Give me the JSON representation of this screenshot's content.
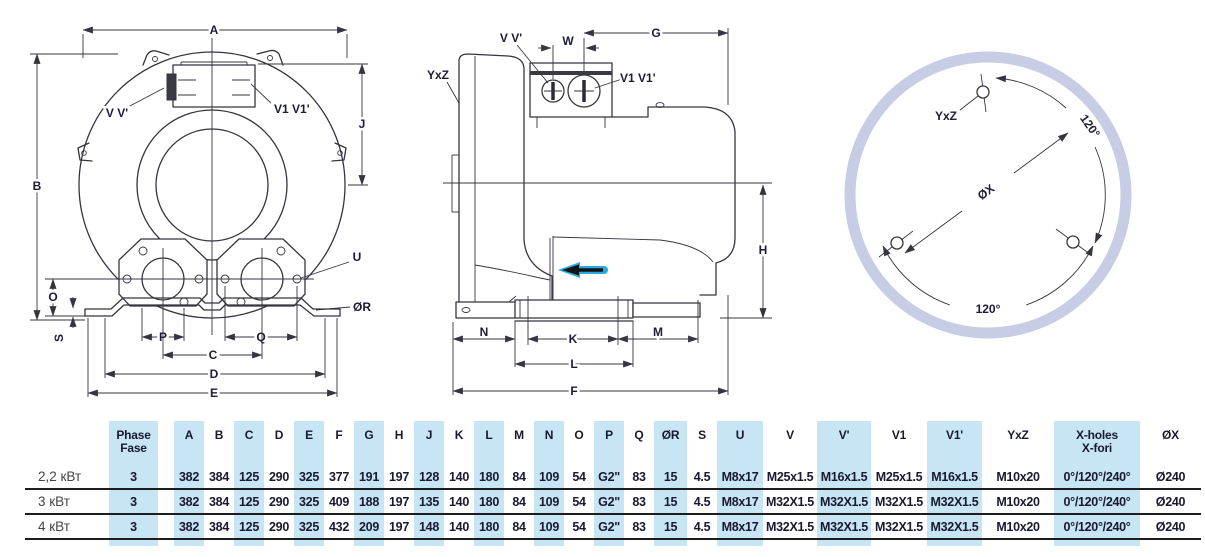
{
  "drawing": {
    "front_view": {
      "labels": {
        "A": "A",
        "B": "B",
        "J": "J",
        "vv": "V V'",
        "v1v1": "V1 V1'",
        "O": "O",
        "S": "S",
        "P": "P",
        "Q": "Q",
        "C": "C",
        "D": "D",
        "E": "E",
        "U": "U",
        "oR": "ØR"
      }
    },
    "side_view": {
      "labels": {
        "yxz": "YxZ",
        "vv": "V V'",
        "w": "W",
        "g": "G",
        "v1v1": "V1 V1'",
        "h": "H",
        "n": "N",
        "k": "K",
        "l": "L",
        "m": "M",
        "f": "F"
      }
    },
    "flange_view": {
      "labels": {
        "yxz": "YxZ",
        "ox": "ØX",
        "angle_top": "120°",
        "angle_bottom": "120°"
      }
    }
  },
  "table": {
    "headers": {
      "phase_line1": "Phase",
      "phase_line2": "Fase",
      "cols": [
        "A",
        "B",
        "C",
        "D",
        "E",
        "F",
        "G",
        "H",
        "J",
        "K",
        "L",
        "M",
        "N",
        "O",
        "P",
        "Q",
        "ØR",
        "S",
        "U",
        "V",
        "V'",
        "V1",
        "V1'",
        "YxZ"
      ],
      "xholes_line1": "X-holes",
      "xholes_line2": "X-fori",
      "ox": "ØX"
    },
    "rows": [
      {
        "label": "2,2 кВт",
        "phase": "3",
        "values": [
          "382",
          "384",
          "125",
          "290",
          "325",
          "377",
          "191",
          "197",
          "128",
          "140",
          "180",
          "84",
          "109",
          "54",
          "G2\"",
          "83",
          "15",
          "4.5",
          "M8x17",
          "M25x1.5",
          "M16x1.5",
          "M25x1.5",
          "M16x1.5",
          "M10x20",
          "0°/120°/240°",
          "Ø240"
        ]
      },
      {
        "label": "3 кВт",
        "phase": "3",
        "values": [
          "382",
          "384",
          "125",
          "290",
          "325",
          "409",
          "188",
          "197",
          "135",
          "140",
          "180",
          "84",
          "109",
          "54",
          "G2\"",
          "83",
          "15",
          "4.5",
          "M8x17",
          "M32X1.5",
          "M32X1.5",
          "M32X1.5",
          "M32X1.5",
          "M10x20",
          "0°/120°/240°",
          "Ø240"
        ]
      },
      {
        "label": "4 кВт",
        "phase": "3",
        "values": [
          "382",
          "384",
          "125",
          "290",
          "325",
          "432",
          "209",
          "197",
          "148",
          "140",
          "180",
          "84",
          "109",
          "54",
          "G2\"",
          "83",
          "15",
          "4.5",
          "M8x17",
          "M32X1.5",
          "M32X1.5",
          "M32X1.5",
          "M32X1.5",
          "M10x20",
          "0°/120°/240°",
          "Ø240"
        ]
      }
    ]
  },
  "colors": {
    "stripe": "#c7e5f5",
    "line": "#35353f",
    "text": "#191930",
    "flange_ring": "#c6cde5",
    "airflow_arrow": "#29abe2"
  }
}
